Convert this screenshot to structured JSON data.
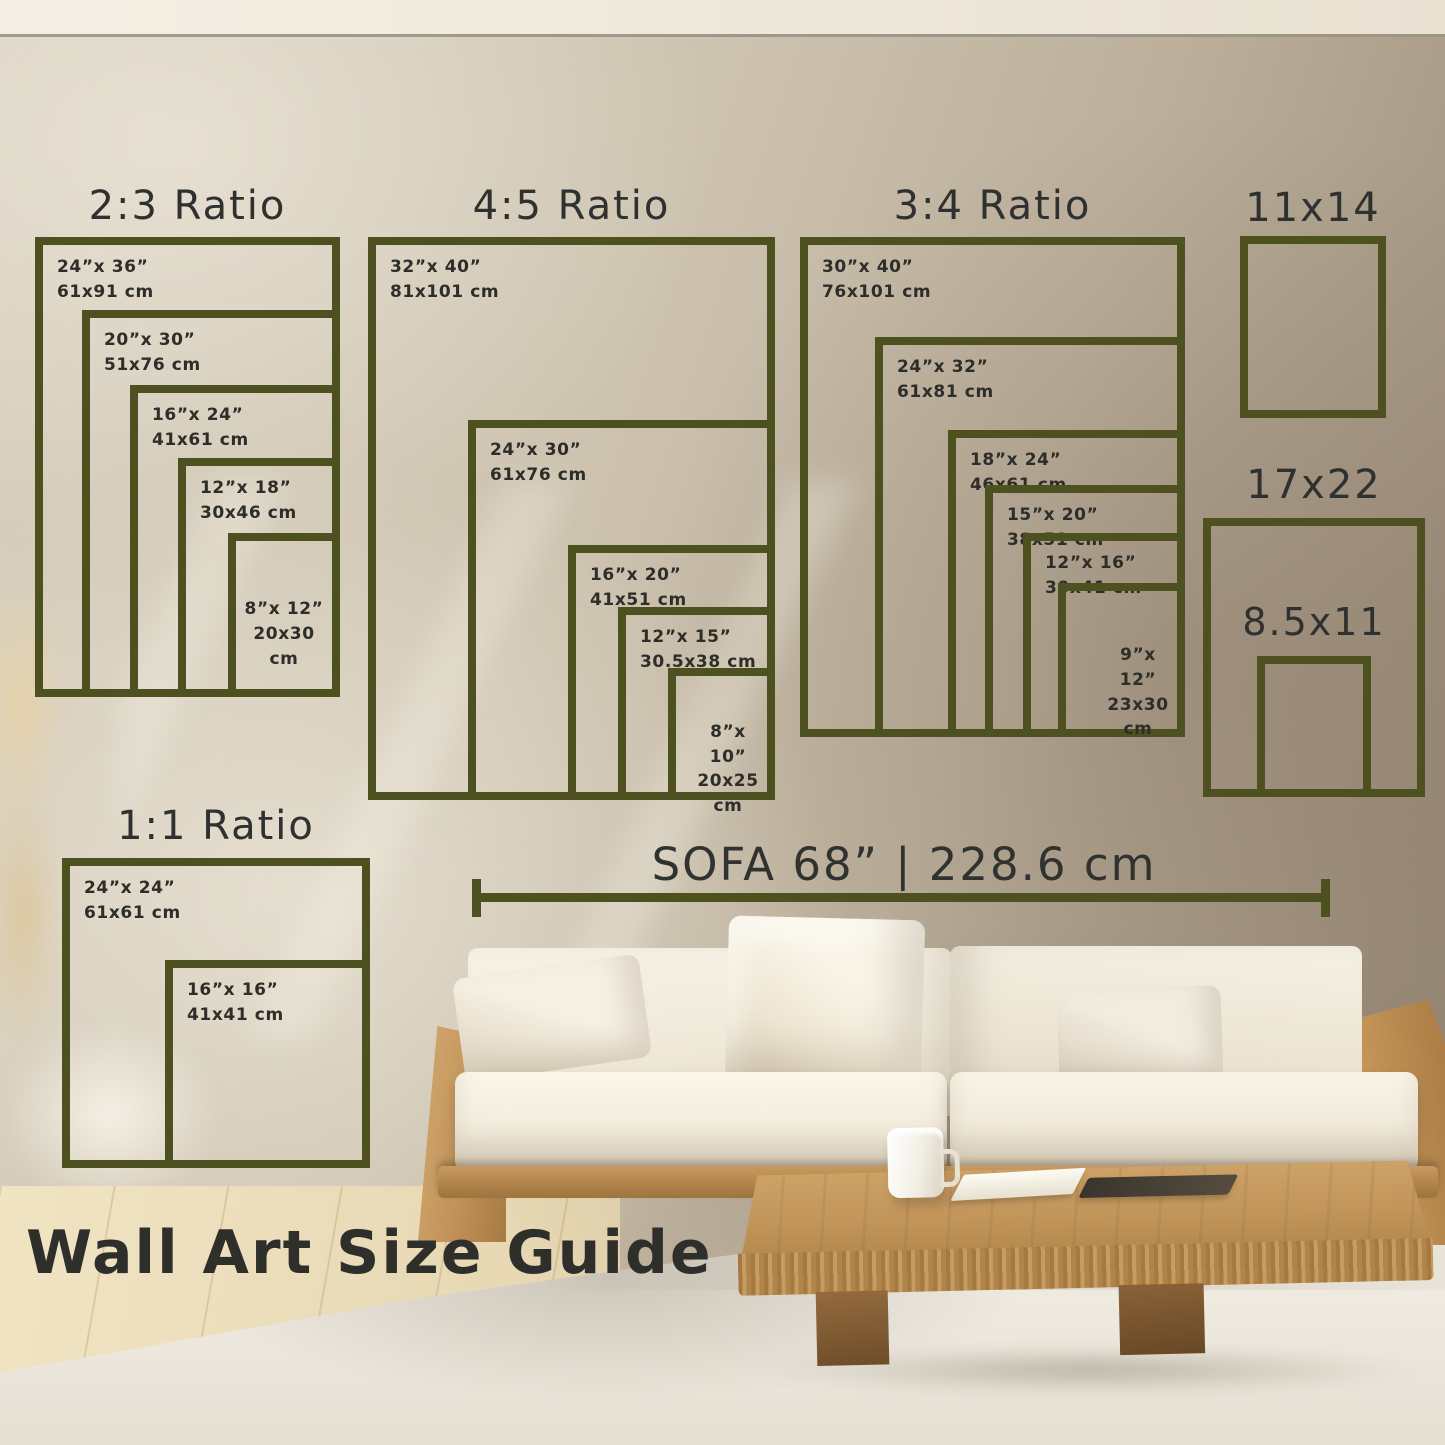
{
  "colors": {
    "frame": "#4d5120",
    "ink": "#2d2d29"
  },
  "groups": [
    {
      "title": "2:3 Ratio",
      "sizes": [
        {
          "inches": "24”x 36”",
          "cm": "61x91 cm"
        },
        {
          "inches": "20”x 30”",
          "cm": "51x76 cm"
        },
        {
          "inches": "16”x 24”",
          "cm": "41x61 cm"
        },
        {
          "inches": "12”x 18”",
          "cm": "30x46 cm"
        },
        {
          "inches": "8”x 12”",
          "cm": "20x30 cm"
        }
      ]
    },
    {
      "title": "4:5 Ratio",
      "sizes": [
        {
          "inches": "32”x 40”",
          "cm": "81x101 cm"
        },
        {
          "inches": "24”x 30”",
          "cm": "61x76 cm"
        },
        {
          "inches": "16”x 20”",
          "cm": "41x51 cm"
        },
        {
          "inches": "12”x 15”",
          "cm": "30.5x38 cm"
        },
        {
          "inches": "8”x 10”",
          "cm": "20x25 cm"
        }
      ]
    },
    {
      "title": "3:4 Ratio",
      "sizes": [
        {
          "inches": "30”x 40”",
          "cm": "76x101 cm"
        },
        {
          "inches": "24”x 32”",
          "cm": "61x81 cm"
        },
        {
          "inches": "18”x 24”",
          "cm": "46x61 cm"
        },
        {
          "inches": "15”x 20”",
          "cm": "38x51 cm"
        },
        {
          "inches": "12”x 16”",
          "cm": "30x41 cm"
        },
        {
          "inches": "9”x 12”",
          "cm": "23x30 cm"
        }
      ]
    },
    {
      "title": "1:1 Ratio",
      "sizes": [
        {
          "inches": "24”x 24”",
          "cm": "61x61 cm"
        },
        {
          "inches": "16”x 16”",
          "cm": "41x41 cm"
        }
      ]
    }
  ],
  "standalone_sizes": [
    {
      "label": "11x14"
    },
    {
      "label": "17x22"
    },
    {
      "label": "8.5x11"
    }
  ],
  "sofa_measure": "SOFA 68” | 228.6 cm",
  "footer_title": "Wall Art Size Guide"
}
